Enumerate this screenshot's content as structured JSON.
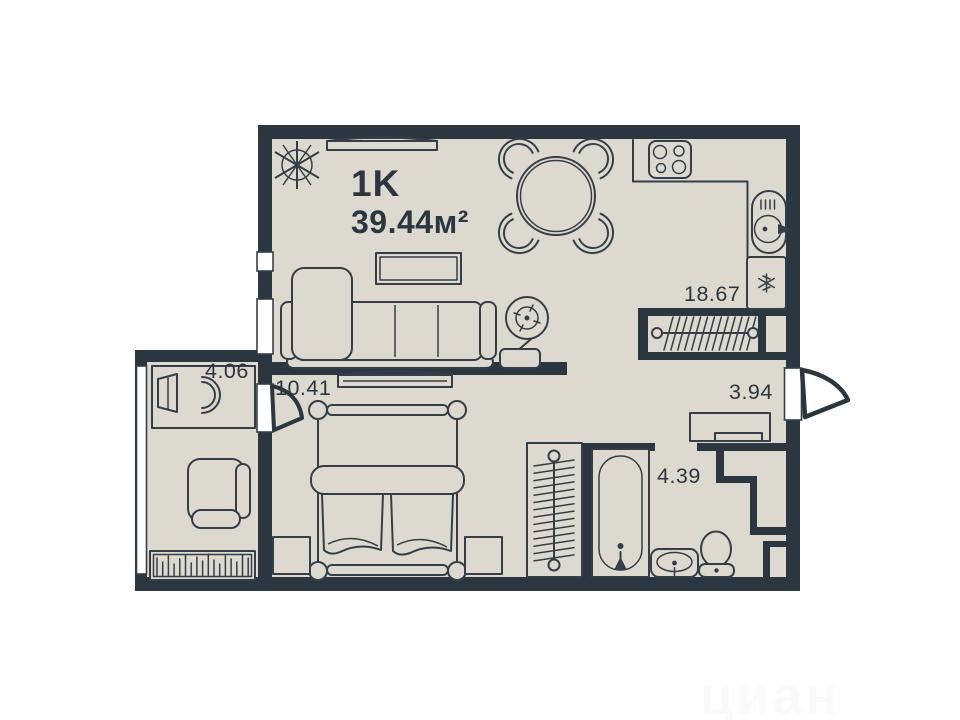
{
  "apartment": {
    "type_label": "1K",
    "total_area_label": "39.44м²"
  },
  "rooms": {
    "kitchen_living": {
      "area": "18.67"
    },
    "bedroom": {
      "area": "10.41"
    },
    "loggia": {
      "area": "4.06"
    },
    "hallway": {
      "area": "3.94"
    },
    "bathroom": {
      "area": "4.39"
    }
  },
  "icons": {
    "north": "compass-rose-icon",
    "stove": "four-burner-stove-icon",
    "kitchen_sink": "round-sink-faucet-icon",
    "fridge": "snowflake-icon",
    "closets": "clothes-rail-hangers-icon",
    "bathtub": "bathtub-icon",
    "washbasin": "oval-basin-icon",
    "toilet": "toilet-icon"
  },
  "colors": {
    "wall": "#2a3740",
    "floor": "#ded9cf",
    "line": "#333f48",
    "label": "#2a3740",
    "window": "#ffffff",
    "watermark": "#fafaf8",
    "background": "#ffffff"
  },
  "watermark": "циан"
}
